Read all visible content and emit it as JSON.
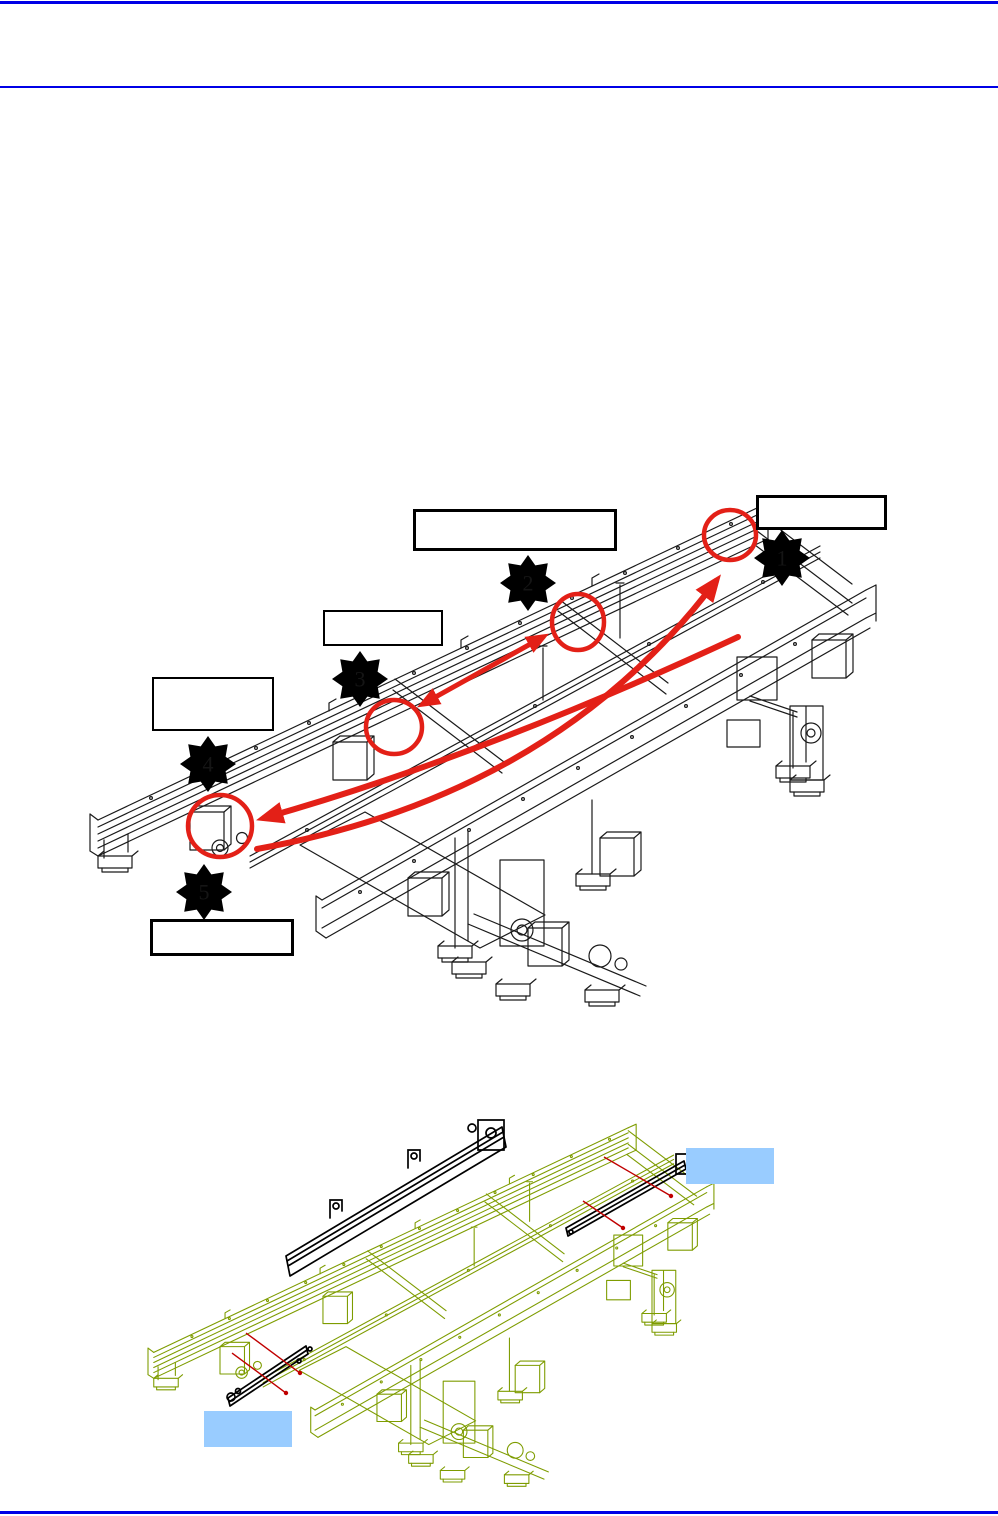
{
  "page": {
    "width": 998,
    "height": 1516,
    "rule_color": "#0000E6",
    "background": "#ffffff"
  },
  "figure1": {
    "kind": "isometric-conveyor-frame-diagram",
    "drawing_color": "#1A1A1A",
    "annotation_color": "#E32017",
    "callouts": [
      {
        "number": "1"
      },
      {
        "number": "2"
      },
      {
        "number": "3"
      },
      {
        "number": "4"
      },
      {
        "number": "5"
      }
    ],
    "label_boxes": [
      {
        "text": ""
      },
      {
        "text": ""
      },
      {
        "text": ""
      },
      {
        "text": ""
      },
      {
        "text": ""
      }
    ]
  },
  "figure2": {
    "kind": "isometric-conveyor-frame-exploded-rails",
    "drawing_color": "#7E9C00",
    "part_color": "#000000",
    "guide_line_color": "#C00000",
    "highlight_color": "#99CCFF",
    "highlight_boxes": [
      {
        "text": ""
      },
      {
        "text": ""
      }
    ]
  }
}
